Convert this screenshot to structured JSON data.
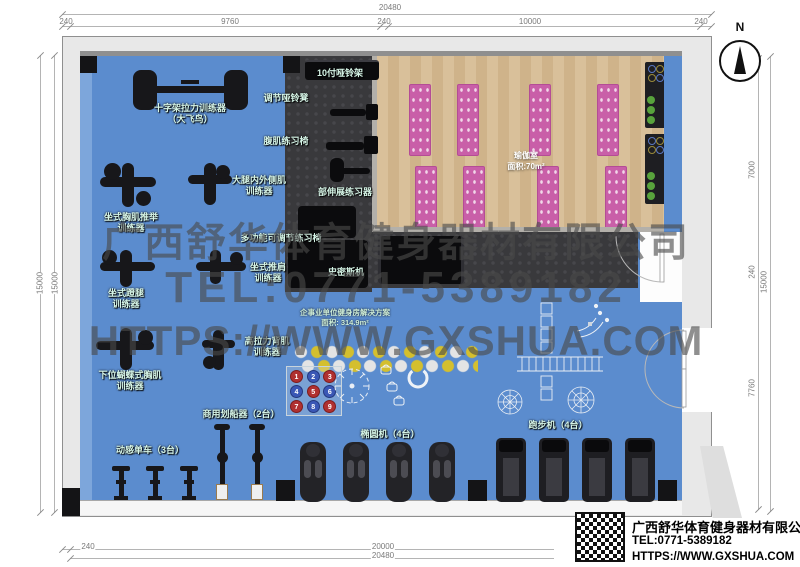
{
  "compass": {
    "label": "N"
  },
  "dims": {
    "top_total": "20480",
    "top_seg": [
      "240",
      "9760",
      "240",
      "10000",
      "240"
    ],
    "left_outer": "15000",
    "left_inner": "15000",
    "right_seg": [
      "7000",
      "240",
      "7760"
    ],
    "right_outer": "15000",
    "bottom_seg": [
      "240",
      "20000"
    ],
    "bottom_total": "20480"
  },
  "watermark": {
    "company": "广西舒华体育健身器材有限公司",
    "tel": "TEL:0771-5389182",
    "url": "HTTPS://WWW.GXSHUA.COM"
  },
  "yoga": {
    "label": "瑜伽室\n面积:70m²"
  },
  "solution": {
    "label": "企事业单位健身房解决方案\n面积: 314.9m²"
  },
  "equipment": {
    "crossover": "十字架拉力训练器\n（大飞鸟）",
    "adj_db_bench": "调节哑铃凳",
    "ab_chair": "腹肌练习椅",
    "db_rack": "10付哑铃架",
    "thigh": "大腿内外侧肌\n训练器",
    "chest_press": "坐式胸肌推举\n训练器",
    "back_stretch": "部伸展练习器",
    "multi_bench": "多功能可调节练习椅",
    "shoulder_press": "坐式推肩\n训练器",
    "smith": "史密斯机",
    "leg_press": "坐式蹬腿\n训练器",
    "lat_pull": "高拉力背肌\n训练器",
    "pec_fly": "下位蝴蝶式胸肌\n训练器",
    "rower": "商用划船器（2台）",
    "spin_bike": "动感单车（3台）",
    "elliptical": "椭圆机（4台）",
    "treadmill": "跑步机（4台）"
  },
  "balls": [
    "1",
    "2",
    "3",
    "4",
    "5",
    "6",
    "7",
    "8",
    "9"
  ],
  "logo": {
    "company": "广西舒华体育健身器材有限公司",
    "tel": "TEL:0771-5389182",
    "url": "HTTPS://WWW.GXSHUA.COM"
  }
}
